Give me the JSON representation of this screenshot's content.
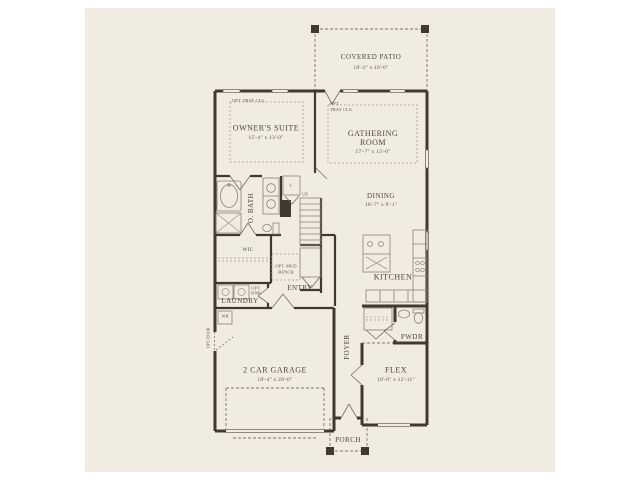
{
  "plan": {
    "rooms": {
      "covered_patio": {
        "name": "COVERED PATIO",
        "dims": "18'-3\" x 10'-0\""
      },
      "owners_suite": {
        "name": "OWNER'S SUITE",
        "dims": "15'-4\" x 13'-0\"",
        "opt": "OPT. TRAY CLG"
      },
      "gathering_room": {
        "name": "GATHERING ROOM",
        "dims": "17'-7\" x 13'-0\"",
        "opt_line1": "OPT.",
        "opt_line2": "TRAY CLG"
      },
      "dining": {
        "name": "DINING",
        "dims": "16'-7\" x 9'-1\""
      },
      "owners_bath": {
        "name": "O. BATH"
      },
      "wic": {
        "name": "WIC"
      },
      "kitchen": {
        "name": "KITCHEN"
      },
      "laundry": {
        "name": "LAUNDRY"
      },
      "entry": {
        "name": "ENTRY"
      },
      "garage": {
        "name": "2 CAR GARAGE",
        "dims": "18'-4\" x 20'-0\""
      },
      "foyer": {
        "name": "FOYER"
      },
      "powder": {
        "name": "PWDR"
      },
      "flex": {
        "name": "FLEX",
        "dims": "10'-0\" x 12'-11\""
      },
      "porch": {
        "name": "PORCH"
      }
    },
    "annotations": {
      "up": "UP",
      "linen": "L",
      "water_heater": "WH",
      "opt_door": "OPT. DOOR",
      "opt_sink_line1": "OPT.",
      "opt_sink_line2": "SINK",
      "opt_mud_line1": "OPT. MUD",
      "opt_mud_line2": "BENCH"
    },
    "colors": {
      "background": "#f1ece1",
      "wall": "#3f3931",
      "line": "#8a8172",
      "dash": "#7d7668",
      "text": "#4c463b"
    }
  }
}
